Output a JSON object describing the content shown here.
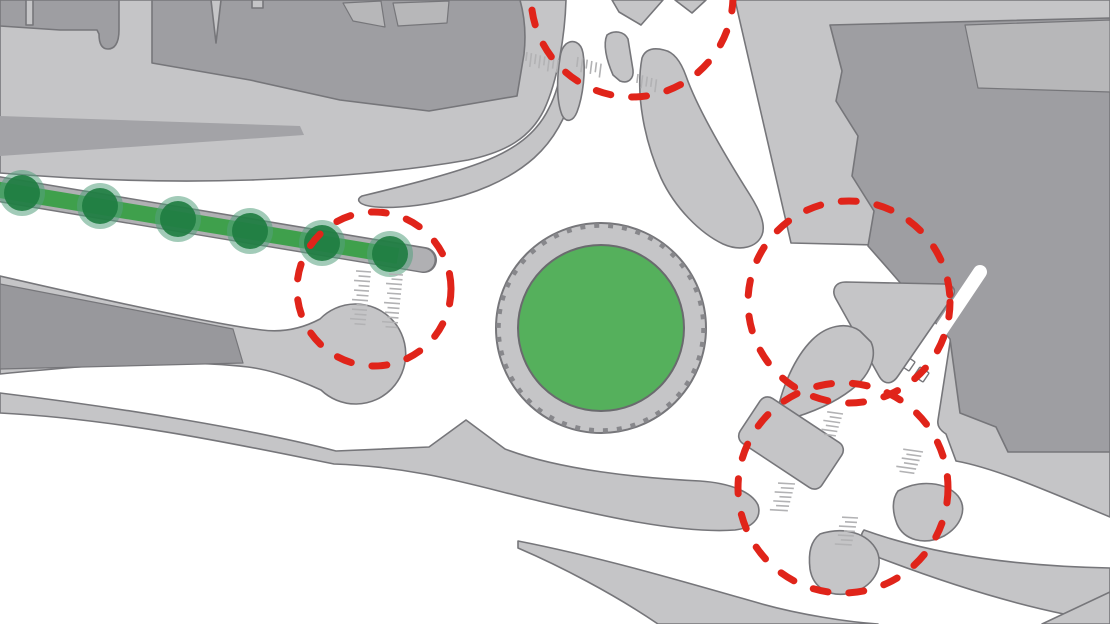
{
  "scene": {
    "width": 1110,
    "height": 624,
    "background": "#ffffff",
    "kind": "urban-roundabout-plan"
  },
  "palette": {
    "road_white": "#ffffff",
    "land": "#c5c5c7",
    "land_stroke": "#76767a",
    "building_dark": "#9e9ea2",
    "building_mid": "#b7b7b9",
    "platform_dark": "#98989c",
    "median_shade": "#a3a3a7",
    "strip_base": "#b0b0b3",
    "hatch_gray": "#b2b2b4",
    "curb_tick": "#87878b",
    "highlight_red": "#e0241a",
    "roundabout_green": "#55b05c",
    "strip_green": "#3fa04c",
    "tree_core": "#1e7c40",
    "tree_halo": "#55a07e",
    "green_stroke": "#6a6a6e"
  },
  "roundabout": {
    "cx": 601,
    "cy": 328,
    "apron_radius": 105,
    "green_radius": 83
  },
  "green_boulevard": {
    "axis": {
      "x1": -20,
      "y1": 186,
      "x2": 424,
      "y2": 260
    },
    "tree_count": 6,
    "trees": [
      {
        "x": 22,
        "y": 193
      },
      {
        "x": 100,
        "y": 206
      },
      {
        "x": 178,
        "y": 219
      },
      {
        "x": 250,
        "y": 231
      },
      {
        "x": 322,
        "y": 243
      },
      {
        "x": 390,
        "y": 254
      }
    ]
  },
  "highlight_circles": [
    {
      "label": "north-crossing",
      "cx": 632,
      "cy": -4,
      "r": 101
    },
    {
      "label": "west-crossing",
      "cx": 374,
      "cy": 289,
      "r": 77
    },
    {
      "label": "east-junction",
      "cx": 849,
      "cy": 302,
      "r": 101
    },
    {
      "label": "southeast-junction",
      "cx": 843,
      "cy": 488,
      "r": 105
    }
  ],
  "map": {
    "layers": [
      {
        "name": "northwest-sidewalk-block",
        "kind": "path",
        "fill": "$land",
        "stroke": "$land_stroke",
        "sw": 1.6,
        "d": "M0,0 L566,0 C565,34 558,80 544,110 C530,138 506,152 468,160 C400,172 331,177 251,180 C161,183 72,179 0,173 Z"
      },
      {
        "name": "northwest-median-shade",
        "kind": "path",
        "fill": "$median_shade",
        "d": "M0,116 L300,126 L304,135 L0,156 Z"
      },
      {
        "name": "northwest-buildings",
        "kind": "path",
        "fill": "$building_dark",
        "stroke": "$land_stroke",
        "sw": 1.6,
        "d": "M0,0 L26,0 L26,25 L33,25 L33,0 L119,0 L119,30 C119,44 114,49 108,49 C101,49 99,42 99,34 L97,30 L60,30 L0,26 Z M152,0 L211,0 L216,43 L221,0 L252,0 L252,8 L263,8 L263,0 L520,0 C525,18 526,36 524,54 L517,96 L429,111 L340,100 L250,80 L152,63 Z"
      },
      {
        "name": "building-roof-a",
        "kind": "path",
        "fill": "$building_mid",
        "stroke": "$land_stroke",
        "sw": 1.2,
        "d": "M343,3 L381,1 L385,27 L353,21 Z"
      },
      {
        "name": "building-roof-b",
        "kind": "path",
        "fill": "$building_mid",
        "stroke": "$land_stroke",
        "sw": 1.2,
        "d": "M393,3 L449,1 L447,23 L398,26 Z"
      },
      {
        "name": "northeast-sidewalk-block",
        "kind": "path",
        "fill": "$land",
        "stroke": "$land_stroke",
        "sw": 1.6,
        "d": "M735,0 L1110,0 L1110,517 C1045,490 995,468 956,461 L946,434 C940,430 937,426 938,420 L958,291 L918,246 L791,243 Z"
      },
      {
        "name": "northeast-building",
        "kind": "path",
        "fill": "$building_dark",
        "stroke": "$land_stroke",
        "sw": 1.6,
        "d": "M830,25 L1110,18 L1110,452 L1008,452 L996,427 L960,413 L950,339 L916,301 L890,271 L868,246 L874,211 L852,176 L858,136 L836,101 L842,71 Z"
      },
      {
        "name": "northeast-building-annex",
        "kind": "path",
        "fill": "$building_mid",
        "stroke": "$land_stroke",
        "sw": 1.2,
        "d": "M965,25 L1110,20 L1110,92 L978,88 Z"
      },
      {
        "name": "east-pedestrian-path",
        "kind": "line",
        "x1": 980,
        "y1": 272,
        "x2": 862,
        "y2": 448,
        "stroke": "$road_white",
        "sw": 14,
        "cap": "round"
      },
      {
        "name": "path-crossing-tab-a",
        "kind": "rect",
        "x": 902,
        "y": 358,
        "w": 11,
        "h": 11,
        "rx": 1,
        "fill": "$road_white",
        "stroke": "$land_stroke",
        "sw": 1.4,
        "rotate": "34 907.5 363.5"
      },
      {
        "name": "path-crossing-tab-b",
        "kind": "rect",
        "x": 916,
        "y": 369,
        "w": 11,
        "h": 11,
        "rx": 1,
        "fill": "$road_white",
        "stroke": "$land_stroke",
        "sw": 1.4,
        "rotate": "34 921.5 374.5"
      },
      {
        "name": "east-triangle-island",
        "kind": "path",
        "fill": "$land",
        "stroke": "$land_stroke",
        "sw": 1.6,
        "d": "M846,282 L944,284 C955,285 957,291 951,299 L898,376 C892,385 884,385 879,376 L836,299 C831,290 835,282 846,282 Z"
      },
      {
        "name": "northwest-splitter-island",
        "kind": "path",
        "fill": "$land",
        "stroke": "$land_stroke",
        "sw": 1.6,
        "d": "M362,196 C395,188 445,176 480,163 C515,150 537,133 549,108 C557,93 561,75 564,58 C566,47 571,44 575,49 C579,56 578,72 574,88 C567,116 554,140 534,158 C508,181 472,195 437,202 C412,207 385,209 369,206 C358,204 356,199 362,196 Z"
      },
      {
        "name": "north-drop-island",
        "kind": "path",
        "fill": "$land",
        "stroke": "$land_stroke",
        "sw": 1.6,
        "d": "M566,44 C573,39 581,42 583,53 C586,71 583,96 577,112 C573,122 566,123 562,115 C556,100 557,76 560,58 C561,50 563,47 566,44 Z"
      },
      {
        "name": "north-fork-island",
        "kind": "path",
        "fill": "$land",
        "stroke": "$land_stroke",
        "sw": 1.6,
        "d": "M607,35 C614,30 624,31 628,39 L633,70 C634,79 628,84 620,81 L613,75 C606,59 603,44 607,35 Z"
      },
      {
        "name": "north-wedge-a",
        "kind": "path",
        "fill": "$land",
        "stroke": "$land_stroke",
        "sw": 1.6,
        "d": "M612,0 L663,0 L641,25 L619,12 Z"
      },
      {
        "name": "north-wedge-b",
        "kind": "path",
        "fill": "$land",
        "stroke": "$land_stroke",
        "sw": 1.6,
        "d": "M675,0 L706,0 L692,13 Z"
      },
      {
        "name": "northeast-splitter-island",
        "kind": "path",
        "fill": "$land",
        "stroke": "$land_stroke",
        "sw": 1.6,
        "d": "M642,58 C635,95 645,142 661,178 C675,208 700,233 723,244 C741,252 757,247 762,235 C766,225 760,211 750,195 C726,157 698,110 686,76 C681,62 674,52 664,50 C652,47 645,50 642,58 Z"
      },
      {
        "name": "southeast-stem-island",
        "kind": "path",
        "fill": "$land",
        "stroke": "$land_stroke",
        "sw": 1.6,
        "d": "M777,413 C782,388 794,358 812,340 C826,326 846,321 860,331 L871,342 C877,355 871,372 857,385 C839,401 815,411 796,417 C784,420 778,418 777,413 Z"
      },
      {
        "name": "west-bulb-island",
        "kind": "path",
        "fill": "$land",
        "stroke": "$land_stroke",
        "sw": 1.6,
        "d": "M0,276 C100,299 212,324 262,330 C285,333 305,327 320,319 A50,50 0 1 1 321,390 C299,380 272,370 248,367 C172,358 80,366 0,374 Z"
      },
      {
        "name": "west-platform",
        "kind": "path",
        "fill": "$platform_dark",
        "stroke": "$land_stroke",
        "sw": 1.2,
        "d": "M0,284 L233,329 L243,363 L0,369 Z"
      },
      {
        "name": "south-median-band",
        "kind": "path",
        "fill": "$land",
        "stroke": "$land_stroke",
        "sw": 1.6,
        "d": "M0,393 C130,409 255,430 336,451 L429,447 L466,420 L505,449 C560,470 640,478 700,481 C730,483 752,492 758,505 C762,518 752,528 735,530 C680,534 598,515 539,501 C479,487 420,467 334,464 C250,447 120,419 0,413 Z"
      },
      {
        "name": "southeast-band",
        "kind": "path",
        "fill": "$land",
        "stroke": "$land_stroke",
        "sw": 1.6,
        "d": "M864,530 C925,552 1005,566 1110,568 L1110,622 C1030,611 948,584 880,558 C864,549 857,539 864,530 Z"
      },
      {
        "name": "south-lower-band",
        "kind": "path",
        "fill": "$land",
        "stroke": "$land_stroke",
        "sw": 1.6,
        "d": "M518,541 C600,557 685,582 762,604 C802,615 848,622 878,624 L658,624 C614,594 560,566 518,548 Z"
      },
      {
        "name": "bottom-right-corner-band",
        "kind": "path",
        "fill": "$land",
        "stroke": "$land_stroke",
        "sw": 1.6,
        "d": "M1042,624 L1110,592 L1110,624 Z"
      },
      {
        "name": "junction-island-east",
        "kind": "path",
        "fill": "$land",
        "stroke": "$land_stroke",
        "sw": 1.6,
        "d": "M898,491 C920,479 946,482 958,496 C968,509 961,526 944,536 C924,546 904,540 897,524 C892,511 892,499 898,491 Z"
      },
      {
        "name": "junction-island-south",
        "kind": "path",
        "fill": "$land",
        "stroke": "$land_stroke",
        "sw": 1.6,
        "d": "M820,534 C844,526 868,533 877,551 C884,568 873,587 851,593 C830,598 813,588 810,569 C808,552 811,541 820,534 Z"
      },
      {
        "name": "junction-island-rect",
        "kind": "rect",
        "x": 742,
        "y": 416,
        "w": 98,
        "h": 54,
        "rx": 9,
        "fill": "$land",
        "stroke": "$land_stroke",
        "sw": 1.6,
        "rotate": "33.5 791 443"
      },
      {
        "name": "roundabout-apron",
        "kind": "circle",
        "cx": 601,
        "cy": 328,
        "r": 105,
        "fill": "$land",
        "stroke": "$land_stroke",
        "sw": 2
      },
      {
        "name": "roundabout-curb-ticks",
        "kind": "circle",
        "cx": 601,
        "cy": 328,
        "r": 102.5,
        "fill": "none",
        "stroke": "$curb_tick",
        "sw": 4.5,
        "dash": "5 9"
      },
      {
        "name": "roundabout-green-center",
        "kind": "circle",
        "cx": 601,
        "cy": 328,
        "r": 83,
        "fill": "$roundabout_green",
        "stroke": "$green_stroke",
        "sw": 2
      },
      {
        "name": "boulevard-outline",
        "kind": "line",
        "x1": -20,
        "y1": 186,
        "x2": 424,
        "y2": 260,
        "stroke": "$land_stroke",
        "sw": 26,
        "cap": "round"
      },
      {
        "name": "boulevard-base",
        "kind": "line",
        "x1": -20,
        "y1": 186,
        "x2": 423,
        "y2": 260,
        "stroke": "$strip_base",
        "sw": 23,
        "cap": "round"
      },
      {
        "name": "boulevard-green-strip",
        "kind": "line",
        "x1": -18,
        "y1": 187,
        "x2": 398,
        "y2": 256,
        "stroke": "$strip_green",
        "sw": 16,
        "cap": "butt"
      },
      {
        "name": "boulevard-trees",
        "kind": "trees",
        "halo_r": 23,
        "halo": "$tree_halo",
        "halo_opacity": 0.55,
        "core_r": 18,
        "core": "$tree_core",
        "core_opacity": 0.9,
        "items": [
          {
            "x": 22,
            "y": 193
          },
          {
            "x": 100,
            "y": 206
          },
          {
            "x": 178,
            "y": 219
          },
          {
            "x": 250,
            "y": 231
          },
          {
            "x": 322,
            "y": 243
          },
          {
            "x": 390,
            "y": 254
          }
        ]
      },
      {
        "name": "crosswalk-north-a",
        "kind": "fringe",
        "x": 527,
        "y": 52,
        "base_angle": 14,
        "count": 8,
        "spacing": 4.6,
        "tick_angle": 97,
        "lengths": [
          9,
          14,
          10,
          13
        ],
        "stroke": "$hatch_gray",
        "sw": 1.6
      },
      {
        "name": "crosswalk-north-b",
        "kind": "fringe",
        "x": 578,
        "y": 57,
        "base_angle": 16,
        "count": 6,
        "spacing": 4.8,
        "tick_angle": 97,
        "lengths": [
          10,
          14,
          9,
          13
        ],
        "stroke": "$hatch_gray",
        "sw": 1.6
      },
      {
        "name": "crosswalk-north-c",
        "kind": "fringe",
        "x": 638,
        "y": 74,
        "base_angle": 16,
        "count": 5,
        "spacing": 4.8,
        "tick_angle": 97,
        "lengths": [
          9,
          13,
          10
        ],
        "stroke": "$hatch_gray",
        "sw": 1.6
      },
      {
        "name": "crosswalk-west-a",
        "kind": "fringe",
        "x": 371,
        "y": 272,
        "base_angle": 96,
        "count": 12,
        "spacing": 4.8,
        "tick_angle": 184,
        "lengths": [
          15,
          12,
          16,
          11
        ],
        "stroke": "$hatch_gray",
        "sw": 1.6
      },
      {
        "name": "crosswalk-west-b",
        "kind": "fringe",
        "x": 403,
        "y": 275,
        "base_angle": 96,
        "count": 12,
        "spacing": 4.8,
        "tick_angle": 184,
        "lengths": [
          14,
          11,
          16,
          12
        ],
        "stroke": "$hatch_gray",
        "sw": 1.6
      },
      {
        "name": "crosswalk-southeast-a",
        "kind": "fringe",
        "x": 843,
        "y": 414,
        "base_angle": 108,
        "count": 6,
        "spacing": 4.6,
        "tick_angle": 188,
        "lengths": [
          16,
          12,
          17,
          13
        ],
        "stroke": "$hatch_gray",
        "sw": 1.6
      },
      {
        "name": "crosswalk-southeast-b",
        "kind": "fringe",
        "x": 923,
        "y": 452,
        "base_angle": 112,
        "count": 6,
        "spacing": 4.6,
        "tick_angle": 188,
        "lengths": [
          20,
          15,
          18,
          14
        ],
        "stroke": "$hatch_gray",
        "sw": 1.6
      },
      {
        "name": "crosswalk-southeast-c",
        "kind": "fringe",
        "x": 795,
        "y": 484,
        "base_angle": 105,
        "count": 7,
        "spacing": 4.6,
        "tick_angle": 183,
        "lengths": [
          17,
          13,
          18,
          12
        ],
        "stroke": "$hatch_gray",
        "sw": 1.6
      },
      {
        "name": "crosswalk-southeast-d",
        "kind": "fringe",
        "x": 858,
        "y": 518,
        "base_angle": 103,
        "count": 7,
        "spacing": 4.6,
        "tick_angle": 183,
        "lengths": [
          16,
          12,
          17,
          11
        ],
        "stroke": "$hatch_gray",
        "sw": 1.6
      },
      {
        "name": "highlight-circle-north",
        "kind": "circle",
        "cx": 632,
        "cy": -4,
        "r": 101,
        "fill": "none",
        "stroke": "$highlight_red",
        "sw": 7,
        "dash": "15 21",
        "cap": "round"
      },
      {
        "name": "highlight-circle-west",
        "kind": "circle",
        "cx": 374,
        "cy": 289,
        "r": 77,
        "fill": "none",
        "stroke": "$highlight_red",
        "sw": 7,
        "dash": "15 21",
        "cap": "round"
      },
      {
        "name": "highlight-circle-east",
        "kind": "circle",
        "cx": 849,
        "cy": 302,
        "r": 101,
        "fill": "none",
        "stroke": "$highlight_red",
        "sw": 7,
        "dash": "15 21",
        "cap": "round"
      },
      {
        "name": "highlight-circle-southeast",
        "kind": "circle",
        "cx": 843,
        "cy": 488,
        "r": 105,
        "fill": "none",
        "stroke": "$highlight_red",
        "sw": 7,
        "dash": "15 21",
        "cap": "round"
      }
    ]
  }
}
